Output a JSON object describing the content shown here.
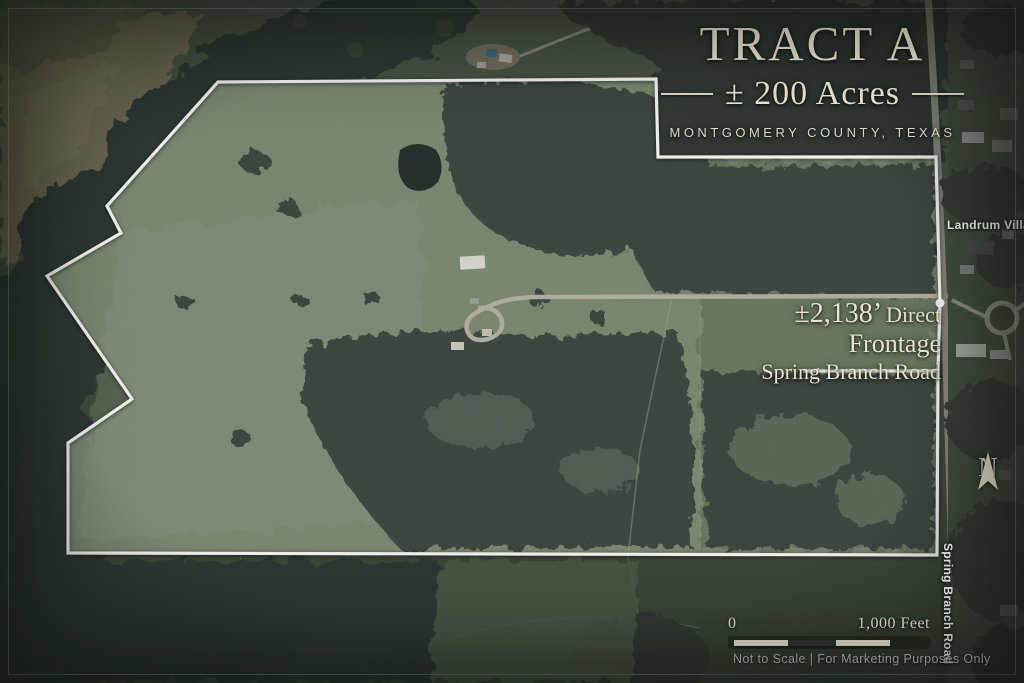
{
  "map": {
    "title": "TRACT A",
    "acreage": "± 200 Acres",
    "county": "MONTGOMERY COUNTY, TEXAS",
    "frontage": {
      "measurement": "±2,138’",
      "qualifier": "Direct",
      "line2": "Frontage",
      "line3": "Spring Branch Road"
    },
    "labels": {
      "village": "Landrum Village",
      "road_vertical": "Spring Branch Road",
      "north": "N"
    },
    "scale": {
      "zero": "0",
      "end": "1,000 Feet"
    },
    "disclaimer": "Not to Scale | For Marketing Purposes Only",
    "colors": {
      "text_cream": "#e9e3d1",
      "boundary_white": "#fdfdf8",
      "pasture_green": "#7b8871",
      "forest_dark": "#3a423a",
      "road_gray": "#aaa89a",
      "pool_blue": "#4e7d9c"
    }
  }
}
